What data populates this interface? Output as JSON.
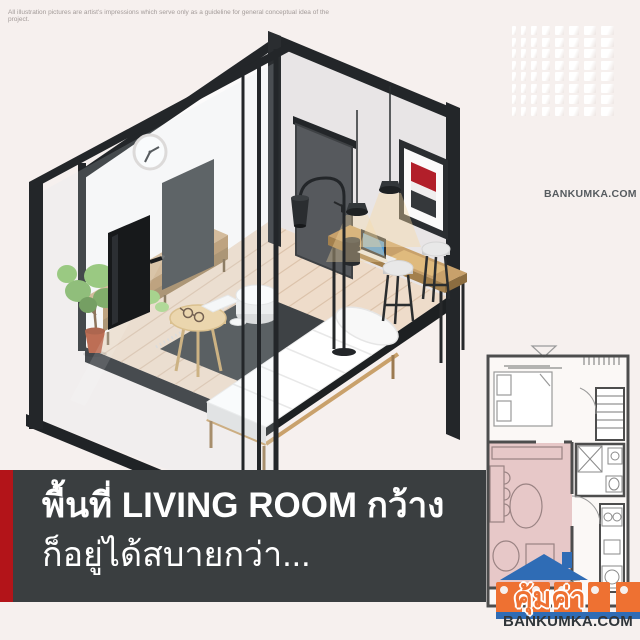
{
  "meta": {
    "background": "#f6f0ee",
    "width": 640,
    "height": 640
  },
  "disclaimer": {
    "text": "All illustration pictures are artist's impressions which serve only as a guideline for general conceptual idea of the project."
  },
  "watermark": {
    "text": "BANKUMKA.COM"
  },
  "caption": {
    "line1": "พื้นที่ LIVING ROOM กว้าง",
    "line2": "ก็อยู่ได้สบายกว่า...",
    "band_color": "#3a3e40",
    "accent_color": "#b31419",
    "text_color": "#ffffff"
  },
  "logo": {
    "thai_text": "คุ้มค่า",
    "site_text": "BANKUMKA.COM",
    "orange": "#ee7132",
    "blue": "#2f6cb5"
  },
  "floor_plan": {
    "highlighted_area": "living-room",
    "highlight_color": "#e7c8c8",
    "wall_color": "#4d4d4d"
  },
  "illustration": {
    "scene": "isometric-living-room",
    "elements": [
      "left-wall",
      "right-wall",
      "wood-floor",
      "wall-clock",
      "glass-partition",
      "tv",
      "tv-panel",
      "sideboard",
      "potted-plant",
      "rug",
      "coffee-table",
      "side-table",
      "daybed",
      "door",
      "wall-art",
      "pendant-lamps",
      "desk",
      "laptop",
      "bar-stools",
      "floor-lamp"
    ],
    "floor_color": "#eedcca",
    "wall_white": "#fcfbfb",
    "wall_gray": "#e8e5e6",
    "frame_black": "#232629",
    "wood_color": "#c8a16b"
  },
  "decor_pattern": {
    "rows": 8,
    "cols": 8,
    "cell_color": "#ffffff"
  }
}
